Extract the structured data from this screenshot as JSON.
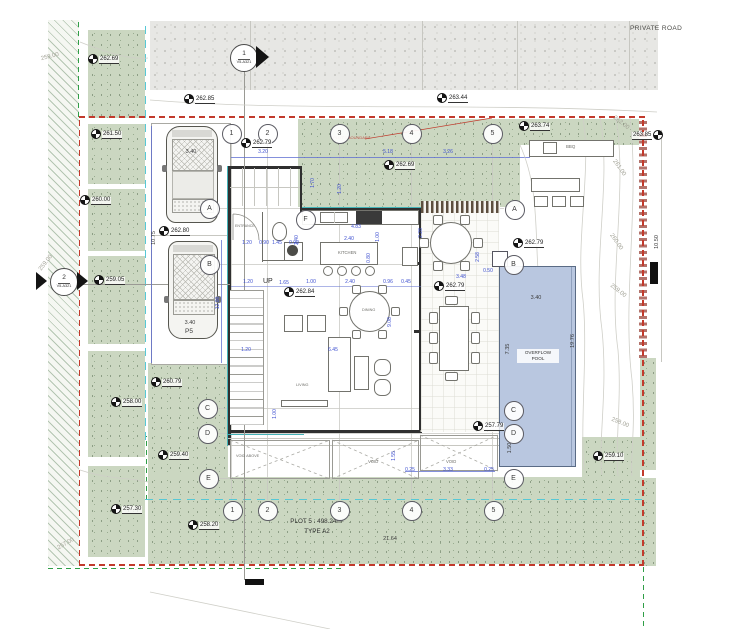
{
  "road": {
    "label": "PRIVATE ROAD"
  },
  "plot": {
    "title": "PLOT 5 : 498.24m²",
    "type": "TYPE A2",
    "boundary_note": "PLOT 5 BOUNDARY"
  },
  "parking": {
    "p5": "P5"
  },
  "pool": {
    "l1": "OVERFLOW",
    "l2": "POOL"
  },
  "bbq": {
    "label": "BBQ"
  },
  "rooms": {
    "entrance": "ENTRANCE",
    "kitchen": "KITCHEN",
    "dining": "DINING",
    "living": "LIVING",
    "up": "UP",
    "void": "VOID",
    "void_above": "VOID ABOVE"
  },
  "section_markers": [
    {
      "num": "1",
      "sheet": "V5-A321"
    },
    {
      "num": "2",
      "sheet": "V5-A321"
    }
  ],
  "grid_bubbles": [
    {
      "label": "1",
      "x": 231,
      "y": 133
    },
    {
      "label": "2",
      "x": 267,
      "y": 133
    },
    {
      "label": "3",
      "x": 339,
      "y": 133
    },
    {
      "label": "4",
      "x": 411,
      "y": 133
    },
    {
      "label": "5",
      "x": 492,
      "y": 133
    },
    {
      "label": "1",
      "x": 232,
      "y": 510
    },
    {
      "label": "2",
      "x": 267,
      "y": 510
    },
    {
      "label": "3",
      "x": 339,
      "y": 510
    },
    {
      "label": "4",
      "x": 411,
      "y": 510
    },
    {
      "label": "5",
      "x": 493,
      "y": 510
    },
    {
      "label": "A",
      "x": 209,
      "y": 208
    },
    {
      "label": "B",
      "x": 209,
      "y": 264
    },
    {
      "label": "C",
      "x": 207,
      "y": 408
    },
    {
      "label": "D",
      "x": 207,
      "y": 433
    },
    {
      "label": "E",
      "x": 208,
      "y": 478
    },
    {
      "label": "A",
      "x": 514,
      "y": 209
    },
    {
      "label": "B",
      "x": 513,
      "y": 264
    },
    {
      "label": "C",
      "x": 513,
      "y": 410
    },
    {
      "label": "D",
      "x": 513,
      "y": 433
    },
    {
      "label": "E",
      "x": 513,
      "y": 478
    },
    {
      "label": "F",
      "x": 305,
      "y": 219
    }
  ],
  "spot_elevations": [
    {
      "v": "262.69",
      "x": 92,
      "y": 62
    },
    {
      "v": "262.85",
      "x": 188,
      "y": 102
    },
    {
      "v": "263.44",
      "x": 441,
      "y": 101
    },
    {
      "v": "262.79",
      "x": 245,
      "y": 146
    },
    {
      "v": "262.69",
      "x": 388,
      "y": 168
    },
    {
      "v": "263.74",
      "x": 523,
      "y": 129
    },
    {
      "v": "263.85",
      "x": 666,
      "y": 138,
      "side": "left"
    },
    {
      "v": "261.50",
      "x": 95,
      "y": 137
    },
    {
      "v": "260.00",
      "x": 84,
      "y": 203
    },
    {
      "v": "262.80",
      "x": 163,
      "y": 234
    },
    {
      "v": "262.79",
      "x": 517,
      "y": 246
    },
    {
      "v": "259.05",
      "x": 98,
      "y": 283
    },
    {
      "v": "262.84",
      "x": 288,
      "y": 295
    },
    {
      "v": "262.79",
      "x": 438,
      "y": 289
    },
    {
      "v": "260.79",
      "x": 155,
      "y": 385
    },
    {
      "v": "258.00",
      "x": 115,
      "y": 405
    },
    {
      "v": "257.79",
      "x": 477,
      "y": 429
    },
    {
      "v": "259.40",
      "x": 162,
      "y": 458
    },
    {
      "v": "259.10",
      "x": 597,
      "y": 459
    },
    {
      "v": "257.30",
      "x": 115,
      "y": 512
    },
    {
      "v": "258.20",
      "x": 192,
      "y": 528
    }
  ],
  "contour_labels": [
    {
      "v": "259.00",
      "x": 50,
      "y": 57,
      "r": -14
    },
    {
      "v": "259.00",
      "x": 46,
      "y": 263,
      "r": -52
    },
    {
      "v": "257.00",
      "x": 66,
      "y": 544,
      "r": -30
    },
    {
      "v": "262.00",
      "x": 621,
      "y": 123,
      "r": 38
    },
    {
      "v": "261.00",
      "x": 619,
      "y": 168,
      "r": 55
    },
    {
      "v": "260.00",
      "x": 616,
      "y": 242,
      "r": 55
    },
    {
      "v": "259.00",
      "x": 618,
      "y": 291,
      "r": 38
    },
    {
      "v": "258.00",
      "x": 620,
      "y": 423,
      "r": 22
    }
  ],
  "dimensions": [
    {
      "v": "3.20",
      "x": 263,
      "y": 152
    },
    {
      "v": "5.18",
      "x": 388,
      "y": 152
    },
    {
      "v": "3.26",
      "x": 448,
      "y": 152
    },
    {
      "v": "1.70",
      "x": 313,
      "y": 183,
      "r": -90
    },
    {
      "v": "1.20",
      "x": 340,
      "y": 189,
      "r": -90
    },
    {
      "v": "4.83",
      "x": 356,
      "y": 227
    },
    {
      "v": "2.40",
      "x": 349,
      "y": 239
    },
    {
      "v": "1.00",
      "x": 378,
      "y": 237,
      "r": -90
    },
    {
      "v": "0.80",
      "x": 369,
      "y": 258,
      "r": -90
    },
    {
      "v": "2.40",
      "x": 297,
      "y": 240,
      "r": -90
    },
    {
      "v": "2.28",
      "x": 421,
      "y": 233,
      "r": -90
    },
    {
      "v": "2.58",
      "x": 478,
      "y": 257,
      "r": -90
    },
    {
      "v": "1.20",
      "x": 247,
      "y": 243
    },
    {
      "v": "0.90",
      "x": 264,
      "y": 243
    },
    {
      "v": "1.45",
      "x": 277,
      "y": 243
    },
    {
      "v": "0.90",
      "x": 294,
      "y": 243
    },
    {
      "v": "1.20",
      "x": 248,
      "y": 282
    },
    {
      "v": "1.65",
      "x": 284,
      "y": 283
    },
    {
      "v": "1.00",
      "x": 311,
      "y": 282
    },
    {
      "v": "2.40",
      "x": 350,
      "y": 282
    },
    {
      "v": "0.96",
      "x": 388,
      "y": 282
    },
    {
      "v": "0.45",
      "x": 406,
      "y": 282
    },
    {
      "v": "3.48",
      "x": 461,
      "y": 277
    },
    {
      "v": "0.50",
      "x": 488,
      "y": 271
    },
    {
      "v": "1.20",
      "x": 246,
      "y": 350
    },
    {
      "v": "6.45",
      "x": 333,
      "y": 350
    },
    {
      "v": "9.08",
      "x": 390,
      "y": 322,
      "r": -90
    },
    {
      "v": "1.00",
      "x": 275,
      "y": 414,
      "r": -90
    },
    {
      "v": "12.00",
      "x": 218,
      "y": 303,
      "r": -90
    },
    {
      "v": "10.75",
      "x": 154,
      "y": 238,
      "r": -90,
      "dark": true
    },
    {
      "v": "10.50",
      "x": 657,
      "y": 242,
      "r": -90,
      "dark": true
    },
    {
      "v": "19.76",
      "x": 573,
      "y": 341,
      "r": -90,
      "dark": true
    },
    {
      "v": "7.35",
      "x": 508,
      "y": 349,
      "r": -90,
      "dark": true
    },
    {
      "v": "3.40",
      "x": 536,
      "y": 298,
      "dark": true
    },
    {
      "v": "1.50",
      "x": 510,
      "y": 448,
      "r": -90,
      "dark": true
    },
    {
      "v": "1.55",
      "x": 394,
      "y": 456,
      "r": -90
    },
    {
      "v": "0.25",
      "x": 410,
      "y": 470
    },
    {
      "v": "3.33",
      "x": 448,
      "y": 470
    },
    {
      "v": "0.25",
      "x": 489,
      "y": 470
    },
    {
      "v": "21.64",
      "x": 390,
      "y": 539,
      "dark": true
    },
    {
      "v": "3.40",
      "x": 191,
      "y": 152,
      "dark": true
    },
    {
      "v": "3.40",
      "x": 190,
      "y": 323,
      "dark": true
    }
  ],
  "colors": {
    "boundary_red": "#c23a2c",
    "setback_cyan": "#57c8d6",
    "neighbor_green": "#2f9e46",
    "dimension_blue": "#3d4fd0",
    "landscape_green": "#cbd7c1",
    "pool_fill": "#b9c7e0"
  }
}
